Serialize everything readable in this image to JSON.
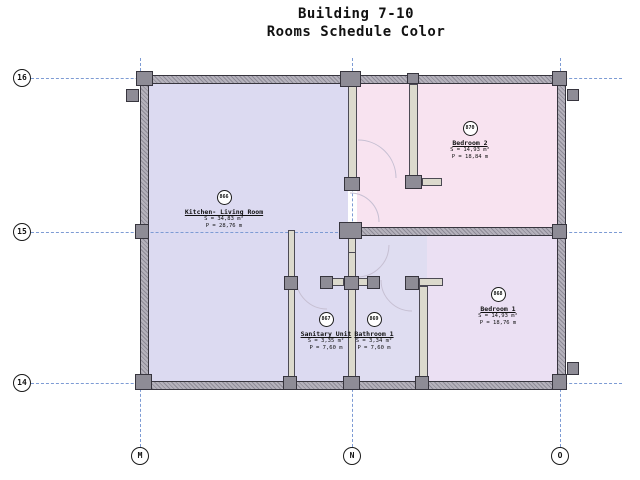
{
  "title": {
    "line1": "Building 7-10",
    "line2": "Rooms Schedule Color"
  },
  "grid": {
    "rows": [
      "16",
      "15",
      "14"
    ],
    "cols": [
      "M",
      "N",
      "O"
    ]
  },
  "rooms": [
    {
      "id": "866",
      "name": "Kitchen- Living Room",
      "area": "S = 34,83 m²",
      "perimeter": "P = 28,76 m"
    },
    {
      "id": "870",
      "name": "Bedroom 2",
      "area": "S = 14,93 m²",
      "perimeter": "P = 18,84 m"
    },
    {
      "id": "868",
      "name": "Bedroom 1",
      "area": "S = 14,93 m²",
      "perimeter": "P = 18,76 m"
    },
    {
      "id": "867",
      "name": "Sanitary Unit",
      "area": "S = 3,35 m²",
      "perimeter": "P = 7,60 m"
    },
    {
      "id": "869",
      "name": "Bathroom 1",
      "area": "S = 3,34 m²",
      "perimeter": "P = 7,60 m"
    }
  ],
  "colors": {
    "kitchen": "#dcdaf1",
    "bedroom2": "#f8e3f0",
    "bedroom1": "#ebe0f3",
    "bathroom": "#dfddf1",
    "gridline": "#7d9bd4",
    "wall": "#9b98a3",
    "arc": "#c6bfd2"
  }
}
